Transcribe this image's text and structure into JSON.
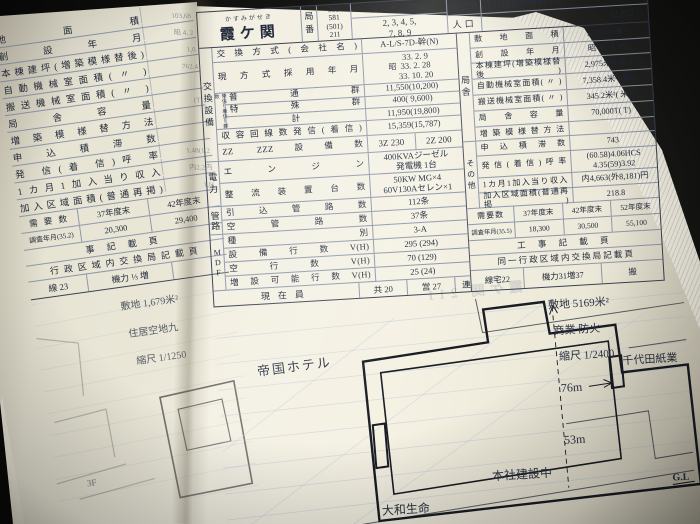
{
  "colors": {
    "paper": "#f2efe1",
    "grid": "#8f98ac",
    "ink": "#242b3c"
  },
  "ghost": {
    "text": "霞ケ関 211"
  },
  "left_page": {
    "rows": [
      {
        "label": "地 面 積",
        "value": "103,68"
      },
      {
        "label": "創 設 年 月",
        "value": "昭 4. 2"
      },
      {
        "label": "本棟建坪(増築模様替後)",
        "value": "1,0"
      },
      {
        "label": "自動機械室面積( 〃 )",
        "value": "762.4"
      },
      {
        "label": "搬送機械室面積( 〃 )",
        "value": ""
      },
      {
        "label": "局 舎 容 量",
        "value": "(T)"
      },
      {
        "label": "増 築 模 様 替 方 法",
        "value": ""
      },
      {
        "label": "申 込 積 滞 数",
        "value": ""
      },
      {
        "label": "発 信(着 信)呼 率",
        "value": "1.48(1.2"
      },
      {
        "label": "1カ月1加入当り収入",
        "value": "内2,2円"
      },
      {
        "label": "加入区域面積(普通再掲)",
        "value": "1,6("
      }
    ],
    "demand": {
      "label": "需 要 数",
      "col1": "37年度末",
      "col2": "42年度末",
      "survey": "調査年月(35.2)",
      "v1": "20,300",
      "v2": "29,400"
    },
    "works": "事 記 載 頁",
    "admin": "行政区域内交換局記載頁",
    "cells": [
      "線 23",
      "機力 ⅓ 増"
    ],
    "map": {
      "site": "敷地 1,679米²",
      "zoning": "住居空地九",
      "scale": "縮尺 1/1250",
      "floor": "3F"
    }
  },
  "right_page": {
    "header": {
      "furigana": "かすみがせき",
      "name": "霞ケ関",
      "bureau_label": "局番",
      "bureau": [
        "591",
        "581",
        "(501)",
        "211"
      ],
      "tandem_label": "タンデム区画",
      "tandem1": "2, 3, 4, 5,",
      "tandem2": "7, 8, 9",
      "loc_label": "所在地",
      "location": "千代田区内幸町 1-1",
      "pop_label": "人口",
      "population": "12,852"
    },
    "exchange": {
      "group": "交換設備",
      "method": {
        "label": "交換方式(会社名)",
        "value": "A-L/S-7D-幹(N)"
      },
      "adopted": {
        "label": "現方式採用年月",
        "era": "昭",
        "lines": [
          "33. 2. 9",
          "33. 2. 28",
          "33. 10. 20"
        ]
      },
      "groups": {
        "side_label": "発信(着信)群数",
        "rows": [
          {
            "label": "普 通 群",
            "value": "11,550(10,200)"
          },
          {
            "label": "特 殊 群",
            "value": "400( 9,600)"
          },
          {
            "label": "計",
            "value": "11,950(19,800)"
          }
        ]
      },
      "capacity": {
        "label": "収容回線数発信(着信)",
        "value": "15,359(15,787)"
      },
      "zz": {
        "label": "ZZ ZZZ設備数",
        "v1": "3Z 230",
        "v2": "2Z 200"
      }
    },
    "power": {
      "group": "電力",
      "rows": [
        {
          "label": "エ ン ジ ン",
          "lines": [
            "400KVAジーゼル",
            "発電機 1台"
          ]
        },
        {
          "label": "整流装置台数",
          "lines": [
            "50KW MG×4",
            "60V130Aセレン×1"
          ]
        }
      ]
    },
    "conduit": {
      "group": "管路",
      "rows": [
        {
          "label": "引 込 管 路 数",
          "value": "112条"
        },
        {
          "label": "空 管 路 数",
          "value": "37条"
        }
      ]
    },
    "mdf": {
      "group": "MDF",
      "rows": [
        {
          "label": "種 別",
          "value": "3-A"
        },
        {
          "label": "設 備 行 数 V(H)",
          "value": "295 (294)"
        },
        {
          "label": "空 行 数 V(H)",
          "value": "70 (129)"
        },
        {
          "label": "増設可能行数V(H)",
          "value": "25 (24)"
        }
      ]
    },
    "staff": {
      "label": "現在員",
      "cells": [
        "共 20",
        "営 27",
        "連"
      ]
    },
    "building": {
      "group": "局舎",
      "rows": [
        {
          "label": "敷 地 面 積",
          "value": "5,169.01米²"
        },
        {
          "label": "創 設 年 月",
          "value": "昭 32. 4. 25"
        },
        {
          "label": "本棟建坪(増築模様替後)",
          "value": "2,975米²( 米²)"
        },
        {
          "label": "自動機械室面積( 〃 )",
          "value": "7,358.4米²( 米²)"
        },
        {
          "label": "搬送機械室面積( 〃 )",
          "value": "345.2米²( 米²)"
        },
        {
          "label": "局 舎 容 量",
          "value": "70,000T( T)"
        },
        {
          "label": "増 築 模 様 替 方 法",
          "value": ""
        }
      ]
    },
    "other": {
      "group": "その他",
      "rows": [
        {
          "label": "申 込 積 滞 数",
          "value": "743"
        },
        {
          "label": "発信(着信)呼率",
          "lines": [
            "(60.58)4.06HCS",
            "4.35(59)3.92"
          ]
        },
        {
          "label": "1カ月1加入当り収入",
          "value": "内4,663(外8,181)円"
        },
        {
          "label": "加入区域面積(普通再掲)",
          "value": "218.8"
        }
      ]
    },
    "demand": {
      "label": "需要数",
      "cols": [
        "37年度末",
        "42年度末",
        "52年度末"
      ],
      "survey": "調査年月(35.5)",
      "values": [
        "18,300",
        "30,500",
        "55,100"
      ]
    },
    "works": "工 事 記 載 頁",
    "admin": "同一行政区域内交換局記載頁",
    "cells": [
      "線宅22",
      "機力31増37",
      "搬"
    ],
    "map": {
      "site": "敷地  5169米²",
      "zoning": "商業 防火",
      "scale": "縮尺 1/2400",
      "hotel": "帝国ホテル",
      "dim_w": "76m",
      "dim_h": "53m",
      "chiyoda": "千代田紙業",
      "honsha": "本社建設中",
      "yamato": "大和生命",
      "gl": "G.L"
    }
  }
}
